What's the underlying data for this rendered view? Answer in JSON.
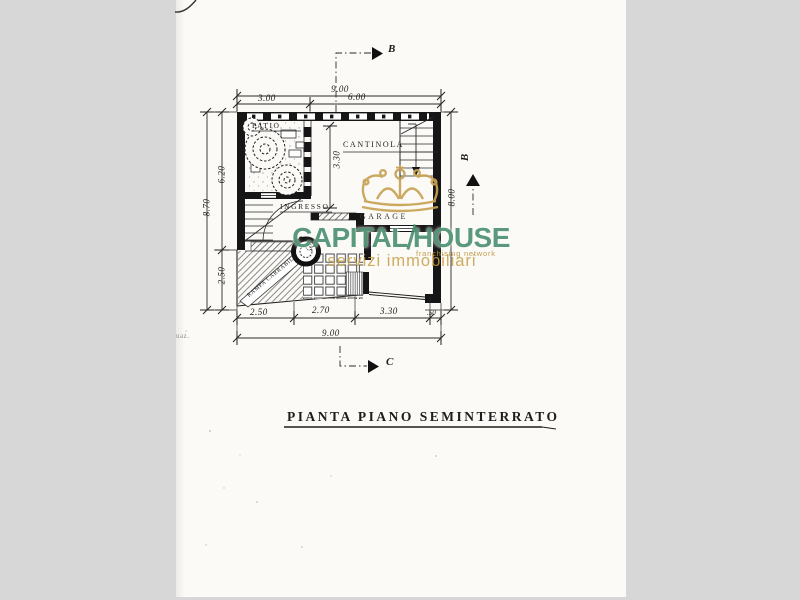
{
  "colors": {
    "paper": "#fbfaf7",
    "background": "#d7d7d7",
    "ink": "#1d1d1d",
    "brand_green": "#3a8462",
    "brand_gold": "#c69e42"
  },
  "icons": {
    "crown": "crown-icon",
    "section_arrow": "section-arrow-icon"
  },
  "plan": {
    "rooms": {
      "patio": "PATIO",
      "cantinola": "CANTINOLA",
      "ingresso": "INGRESSO",
      "garage": "GARAGE"
    },
    "ramp_label": "RAMPA CARRABILE",
    "dims": {
      "top_total": "9.00",
      "top_left": "3.00",
      "top_right": "6.00",
      "left_upper": "6.20",
      "left_total": "8.70",
      "left_lower": "2.50",
      "right_height": "8.00",
      "cantinola_height": "3.30",
      "bottom_1": "2.50",
      "bottom_2": "2.70",
      "bottom_3": "3.30",
      "bottom_4": ".50",
      "bottom_total": "9.00"
    },
    "section_markers": {
      "top": "B",
      "right": "B",
      "bottom": "C"
    },
    "caption": "PIANTA PIANO SEMINTERRATO",
    "margin_note": "uaz."
  },
  "watermark": {
    "brand_part1": "CAPITAL",
    "brand_part2": "HOUSE",
    "tagline": "franchising network",
    "subtitle": "servizi immobiliari"
  }
}
